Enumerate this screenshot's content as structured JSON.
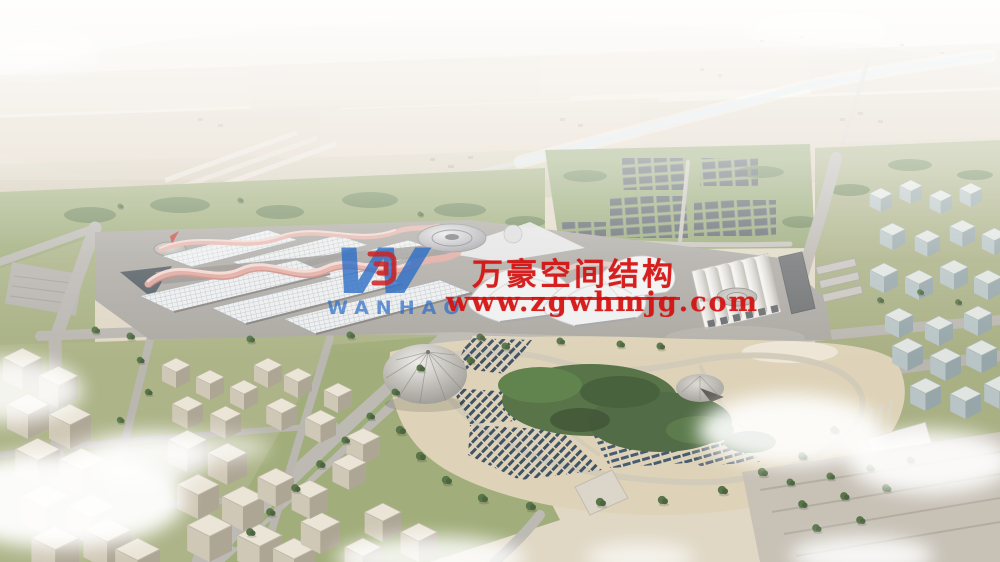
{
  "scene": {
    "caption": "Aerial rendering of a large exhibition center with rippled membrane roofs, a landscaped park with solar panel rows, farmland horizon, canal, warehouse district and surrounding city blocks"
  },
  "watermark": {
    "logo_letter": "W",
    "logo_text": "WANHAO",
    "company_name_cn": "万豪空间结构",
    "website_url": "www.zgwhmjg.com",
    "red": "#d40f0f",
    "blue": "#2e6fc7"
  },
  "palette": {
    "membrane_pink": "#dfa198",
    "park_sand": "#dcd0b4",
    "roof_white": "#ebedef",
    "panel_blue": "#32465c"
  }
}
